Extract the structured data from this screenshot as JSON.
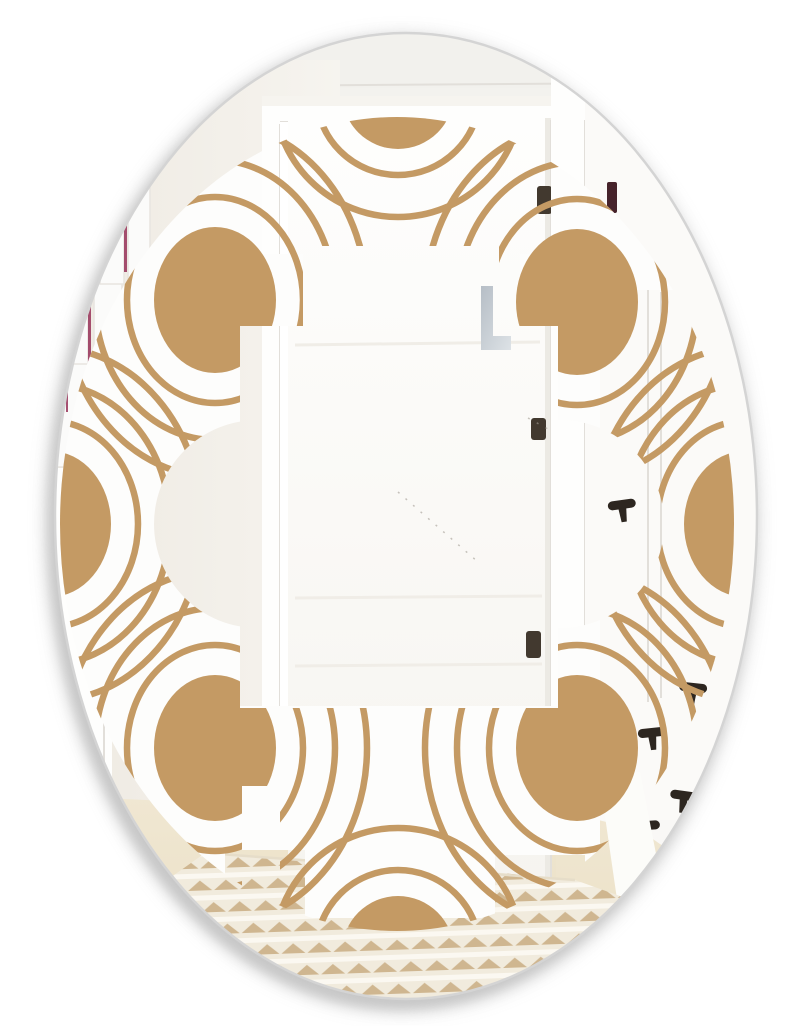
{
  "meta": {
    "description": "Oval frameless wall mirror with printed art deco pattern of tan circles and concentric arcs, reflecting a hallway with an open white door, gallery frames, black coat hooks and a striped rug on a wood floor"
  },
  "colors": {
    "page": "#ffffff",
    "tan": "#c49a64",
    "frost": "#fdfdfc",
    "wall_top": "#f2f1ed",
    "wall_bottom": "#fbfaf8",
    "eggshell": "#eee9e1",
    "door_white": "#fefefd",
    "door_shade": "#f6f4ef",
    "trim_line": "#e2dfda",
    "hinge_dark": "#42392f",
    "distant_hinge": "#46232b",
    "hook_dark": "#2d2620",
    "maroon": "#963158",
    "wood_floor": "#f0e7d2",
    "wood_floor_deep": "#e9dec2",
    "rug_base": "#f1ebdd",
    "rug_tan": "#cbb188",
    "rug_white": "#fbf8f1",
    "handle_gray": "#b6bec6",
    "handle_gray_light": "#dde2e6",
    "rim_gray": "#d4d4d4",
    "shadow_gray": "#c6c6c6",
    "scratch": "#a39d94"
  },
  "mirror": {
    "cx": 406,
    "cy": 516,
    "rx": 351,
    "ry": 483
  },
  "pattern": {
    "ellipse": {
      "cx": 397,
      "cy": 524,
      "rx": 337,
      "ry": 407
    },
    "ring_stroke_width": 6.5,
    "motifs": [
      {
        "cx": 398,
        "cy": 93,
        "rx": 56,
        "ry": 56,
        "rings": [
          [
            82,
            82
          ],
          [
            124,
            124
          ]
        ]
      },
      {
        "cx": 398,
        "cy": 952,
        "rx": 56,
        "ry": 56,
        "rings": [
          [
            82,
            82
          ],
          [
            124,
            124
          ]
        ]
      },
      {
        "cx": 215,
        "cy": 300,
        "rx": 61,
        "ry": 73,
        "rings": [
          [
            88,
            103
          ],
          [
            120,
            140
          ],
          [
            152,
            177
          ]
        ]
      },
      {
        "cx": 577,
        "cy": 302,
        "rx": 61,
        "ry": 73,
        "rings": [
          [
            88,
            103
          ],
          [
            120,
            140
          ],
          [
            152,
            177
          ]
        ]
      },
      {
        "cx": 215,
        "cy": 748,
        "rx": 61,
        "ry": 73,
        "rings": [
          [
            88,
            103
          ],
          [
            120,
            140
          ],
          [
            152,
            177
          ]
        ]
      },
      {
        "cx": 577,
        "cy": 748,
        "rx": 61,
        "ry": 73,
        "rings": [
          [
            88,
            103
          ],
          [
            120,
            140
          ],
          [
            152,
            177
          ]
        ]
      },
      {
        "cx": 50,
        "cy": 524,
        "rx": 61,
        "ry": 73,
        "rings": [
          [
            88,
            103
          ],
          [
            120,
            140
          ],
          [
            152,
            177
          ]
        ]
      },
      {
        "cx": 745,
        "cy": 524,
        "rx": 61,
        "ry": 73,
        "rings": [
          [
            88,
            103
          ],
          [
            120,
            140
          ],
          [
            152,
            177
          ]
        ]
      }
    ]
  },
  "window": {
    "tan_holes": {
      "rects": [
        [
          240,
          326,
          318,
          382
        ],
        [
          303,
          246,
          196,
          460
        ],
        [
          242,
          786,
          38,
          116
        ]
      ],
      "circles": [
        [
          258,
          524,
          104
        ],
        [
          560,
          524,
          104
        ]
      ]
    },
    "frost_holes": {
      "rects": [
        [
          262,
          108,
          298,
          146
        ],
        [
          303,
          126,
          217,
          580
        ],
        [
          240,
          326,
          318,
          380
        ],
        [
          600,
          290,
          160,
          630
        ],
        [
          225,
          850,
          80,
          176
        ],
        [
          495,
          855,
          90,
          171
        ],
        [
          305,
          918,
          190,
          108
        ]
      ],
      "circles": [
        [
          258,
          524,
          104
        ],
        [
          560,
          524,
          104
        ]
      ]
    }
  },
  "reflection": {
    "hooks": [
      [
        622,
        506,
        -8
      ],
      [
        693,
        689,
        6
      ],
      [
        652,
        734,
        -6
      ],
      [
        684,
        797,
        8
      ],
      [
        646,
        827,
        -4
      ]
    ],
    "hinges": [
      [
        537,
        186,
        15,
        28
      ],
      [
        531,
        418,
        15,
        22
      ],
      [
        526,
        631,
        15,
        27
      ]
    ],
    "distant_hinge": [
      607,
      182,
      10,
      31
    ],
    "frame_boards": [
      [
        50,
        95,
        38,
        372
      ],
      [
        94,
        124,
        28,
        342
      ],
      [
        128,
        154,
        22,
        312
      ],
      [
        58,
        302,
        30,
        62
      ],
      [
        100,
        232,
        24,
        52
      ],
      [
        134,
        282,
        18,
        46
      ]
    ],
    "maroon_lines": [
      [
        88,
        118,
        3,
        160
      ],
      [
        88,
        300,
        3,
        95
      ],
      [
        124,
        152,
        3,
        120
      ],
      [
        126,
        296,
        3,
        60
      ],
      [
        143,
        305,
        2,
        38
      ],
      [
        62,
        250,
        3,
        145
      ],
      [
        66,
        368,
        2,
        44
      ],
      [
        20,
        396,
        3,
        158
      ]
    ],
    "scratches": [
      [
        398,
        492,
        478,
        562
      ],
      [
        528,
        418,
        640,
        480
      ]
    ]
  }
}
